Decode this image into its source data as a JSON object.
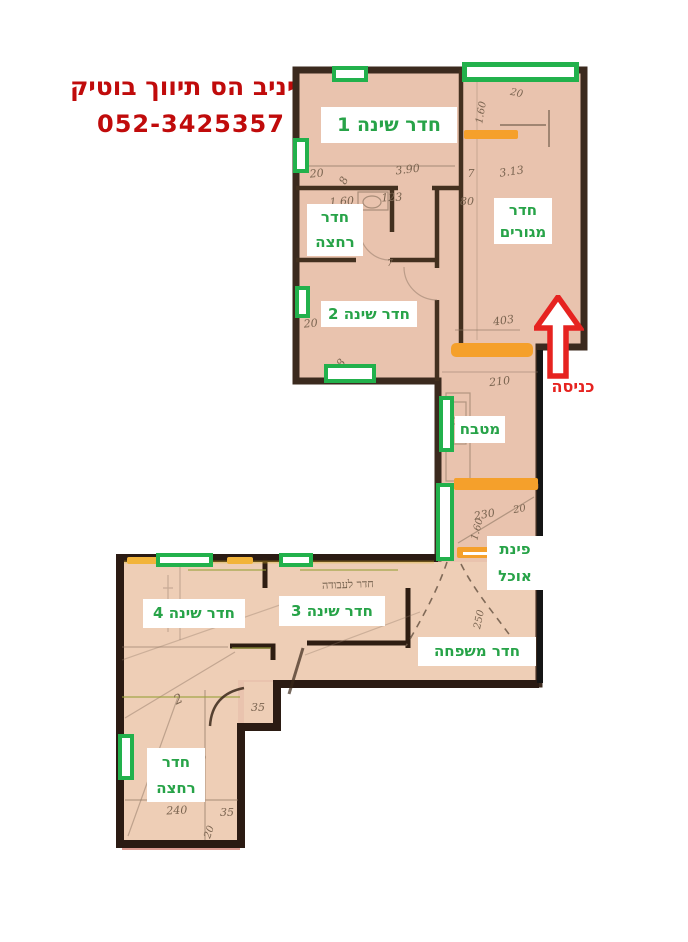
{
  "header": {
    "agency": "יניב הס תיווך בוטיק",
    "phone": "052-3425357"
  },
  "rooms": {
    "bedroom1": "חדר שינה 1",
    "living": "חדר מגורים",
    "bath_top": "חדר רחצה",
    "bedroom2": "חדר שינה 2",
    "kitchen": "מטבח",
    "dining": "פינת אוכל",
    "bedroom3": "חדר שינה 3",
    "bedroom4": "חדר שינה 4",
    "family": "חדר משפחה",
    "bath_bottom": "חדר רחצה"
  },
  "entrance_label": "כניסה",
  "plan": {
    "note": "חדר לעבודה",
    "measurements": [
      "20",
      "3.90",
      "7",
      "3.13",
      "1.60",
      "123",
      "80",
      "20",
      "1.60",
      "403",
      "210",
      "230",
      "20",
      "1.60",
      "35",
      "2",
      "3.08",
      "240",
      "35",
      "250",
      "8",
      "8",
      "7",
      "20",
      "20"
    ]
  },
  "colors": {
    "brand_red": "#c00b0b",
    "label_green": "#27a348",
    "marker_green": "#22b14c",
    "door_orange": "#f5a02b",
    "door_yellow": "#f2b43a",
    "arrow_red": "#e62320"
  }
}
